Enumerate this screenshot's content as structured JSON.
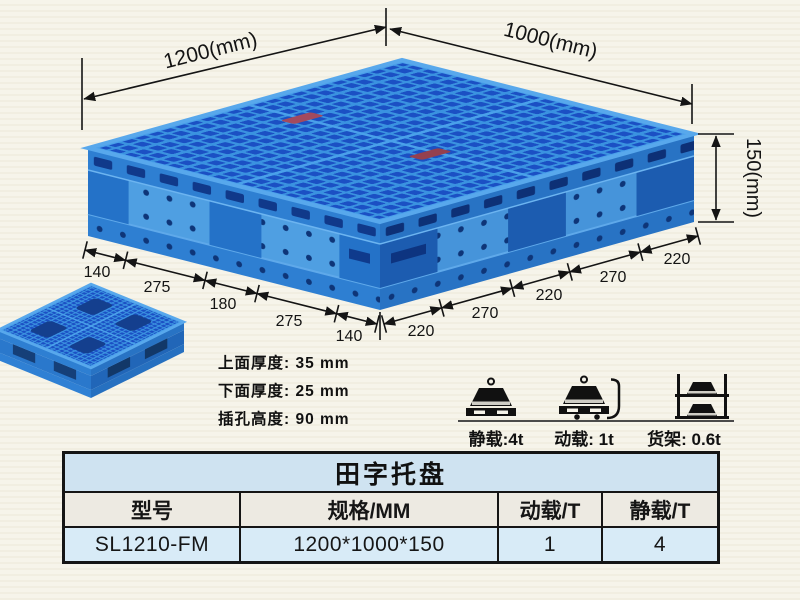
{
  "dims": {
    "length": "1200(mm)",
    "width": "1000(mm)",
    "height": "150(mm)",
    "left_chain": [
      "140",
      "275",
      "180",
      "275",
      "140"
    ],
    "right_chain": [
      "220",
      "270",
      "220",
      "270",
      "220"
    ]
  },
  "notes": [
    "上面厚度: 35 mm",
    "下面厚度: 25 mm",
    "插孔高度: 90 mm"
  ],
  "loads": [
    {
      "icon": "static-load-icon",
      "label": "静载:4t"
    },
    {
      "icon": "dynamic-load-icon",
      "label": "动载: 1t"
    },
    {
      "icon": "rack-load-icon",
      "label": "货架: 0.6t"
    }
  ],
  "table": {
    "title": "田字托盘",
    "headers": [
      "型号",
      "规格/MM",
      "动载/T",
      "静载/T"
    ],
    "row": [
      "SL1210-FM",
      "1200*1000*150",
      "1",
      "4"
    ]
  },
  "colors": {
    "pallet_blue": "#3a92e0",
    "pallet_hole_blue": "#1b50c4",
    "pallet_side_blue": "#2e7fd2",
    "background": "#f6f4ea",
    "table_title_bg": "#cfe3f1",
    "table_header_bg": "#edeae2",
    "table_data_bg": "#d8ebf7",
    "dim_line": "#141414"
  }
}
